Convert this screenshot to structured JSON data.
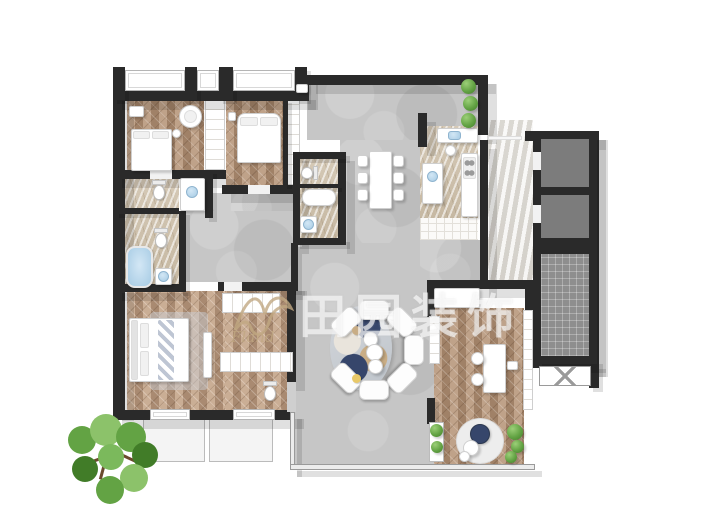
{
  "watermark": {
    "brand_text": "田园装饰",
    "logo_text": "Fland"
  },
  "colors": {
    "wall": "#2a2a2a",
    "wood": "#a08167",
    "wood2": "#bfa289",
    "concrete": "#c6c6c6",
    "marble": "#d5c9b6",
    "marble2": "#c6b8a2",
    "lobby": "#eae8e3",
    "lobby2": "#dcd8d1",
    "shaft": "#7c7c7c",
    "stair": "#8e8e8e",
    "water": "#a6cbe4",
    "plant": "#63a344",
    "plant2": "#417c28",
    "navy": "#36466b",
    "tan": "#c9ad85",
    "gold": "#e9c968",
    "trunk": "#6b4a2e",
    "shadow": "rgba(0,0,0,0.12)",
    "wm_white": "rgba(255,255,255,0.62)",
    "wm_tan": "rgba(193,168,130,0.8)"
  }
}
